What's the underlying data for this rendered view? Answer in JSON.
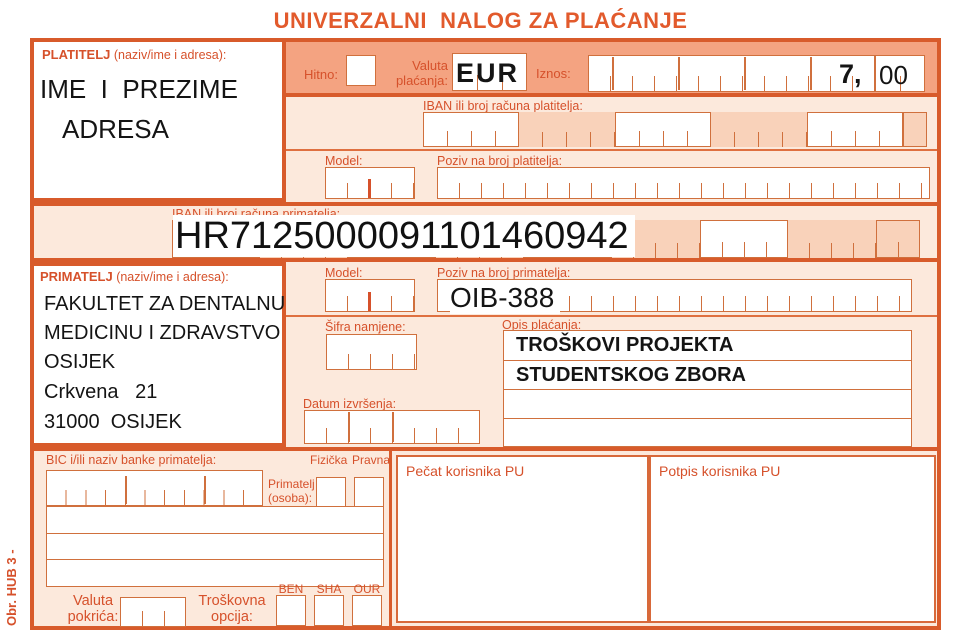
{
  "title": "UNIVERZALNI  NALOG ZA PLAĆANJE",
  "form_code": "Obr. HUB 3 -",
  "colors": {
    "accent_border": "#d85b2b",
    "band": "#f4a381",
    "row_bg": "#fce9dc",
    "cell_shade": "#f9d2ba",
    "label": "#d6512b"
  },
  "payer": {
    "label": "PLATITELJ",
    "label_suffix": " (naziv/ime i adresa):",
    "line1": "IME  I  PREZIME",
    "line2": "ADRESA"
  },
  "urgency": {
    "label": "Hitno:"
  },
  "currency": {
    "label": "Valuta plaćanja:",
    "value": "EUR"
  },
  "amount": {
    "label": "Iznos:",
    "value_main": "7,",
    "value_cents": "00"
  },
  "payer_iban": {
    "label": "IBAN ili broj računa platitelja:"
  },
  "payer_model": {
    "label": "Model:"
  },
  "payer_reference": {
    "label": "Poziv na broj platitelja:"
  },
  "recipient_iban": {
    "label": "IBAN ili broj računa primatelja:",
    "value": "HR7125000091101460942"
  },
  "recipient": {
    "label": "PRIMATELJ",
    "label_suffix": " (naziv/ime i adresa):",
    "lines": [
      "FAKULTET ZA DENTALNU",
      "MEDICINU I ZDRAVSTVO",
      "OSIJEK",
      "Crkvena   21",
      "31000  OSIJEK"
    ]
  },
  "recipient_model": {
    "label": "Model:"
  },
  "recipient_reference": {
    "label": "Poziv na broj primatelja:",
    "value": "OIB-388"
  },
  "purpose_code": {
    "label": "Šifra namjene:"
  },
  "description": {
    "label": "Opis plaćanja:",
    "line1": "TROŠKOVI PROJEKTA",
    "line2": "STUDENTSKOG ZBORA"
  },
  "execution_date": {
    "label": "Datum izvršenja:"
  },
  "bank": {
    "label": "BIC i/ili naziv banke primatelja:"
  },
  "person_type": {
    "fizicka": "Fizička",
    "pravna": "Pravna",
    "recipient_person": "Primatelj (osoba):"
  },
  "cover_currency": {
    "label": "Valuta pokrića:"
  },
  "cost_option": {
    "label": "Troškovna opcija:",
    "ben": "BEN",
    "sha": "SHA",
    "our": "OUR"
  },
  "stamp": {
    "label": "Pečat korisnika PU"
  },
  "signature": {
    "label": "Potpis korisnika PU"
  }
}
